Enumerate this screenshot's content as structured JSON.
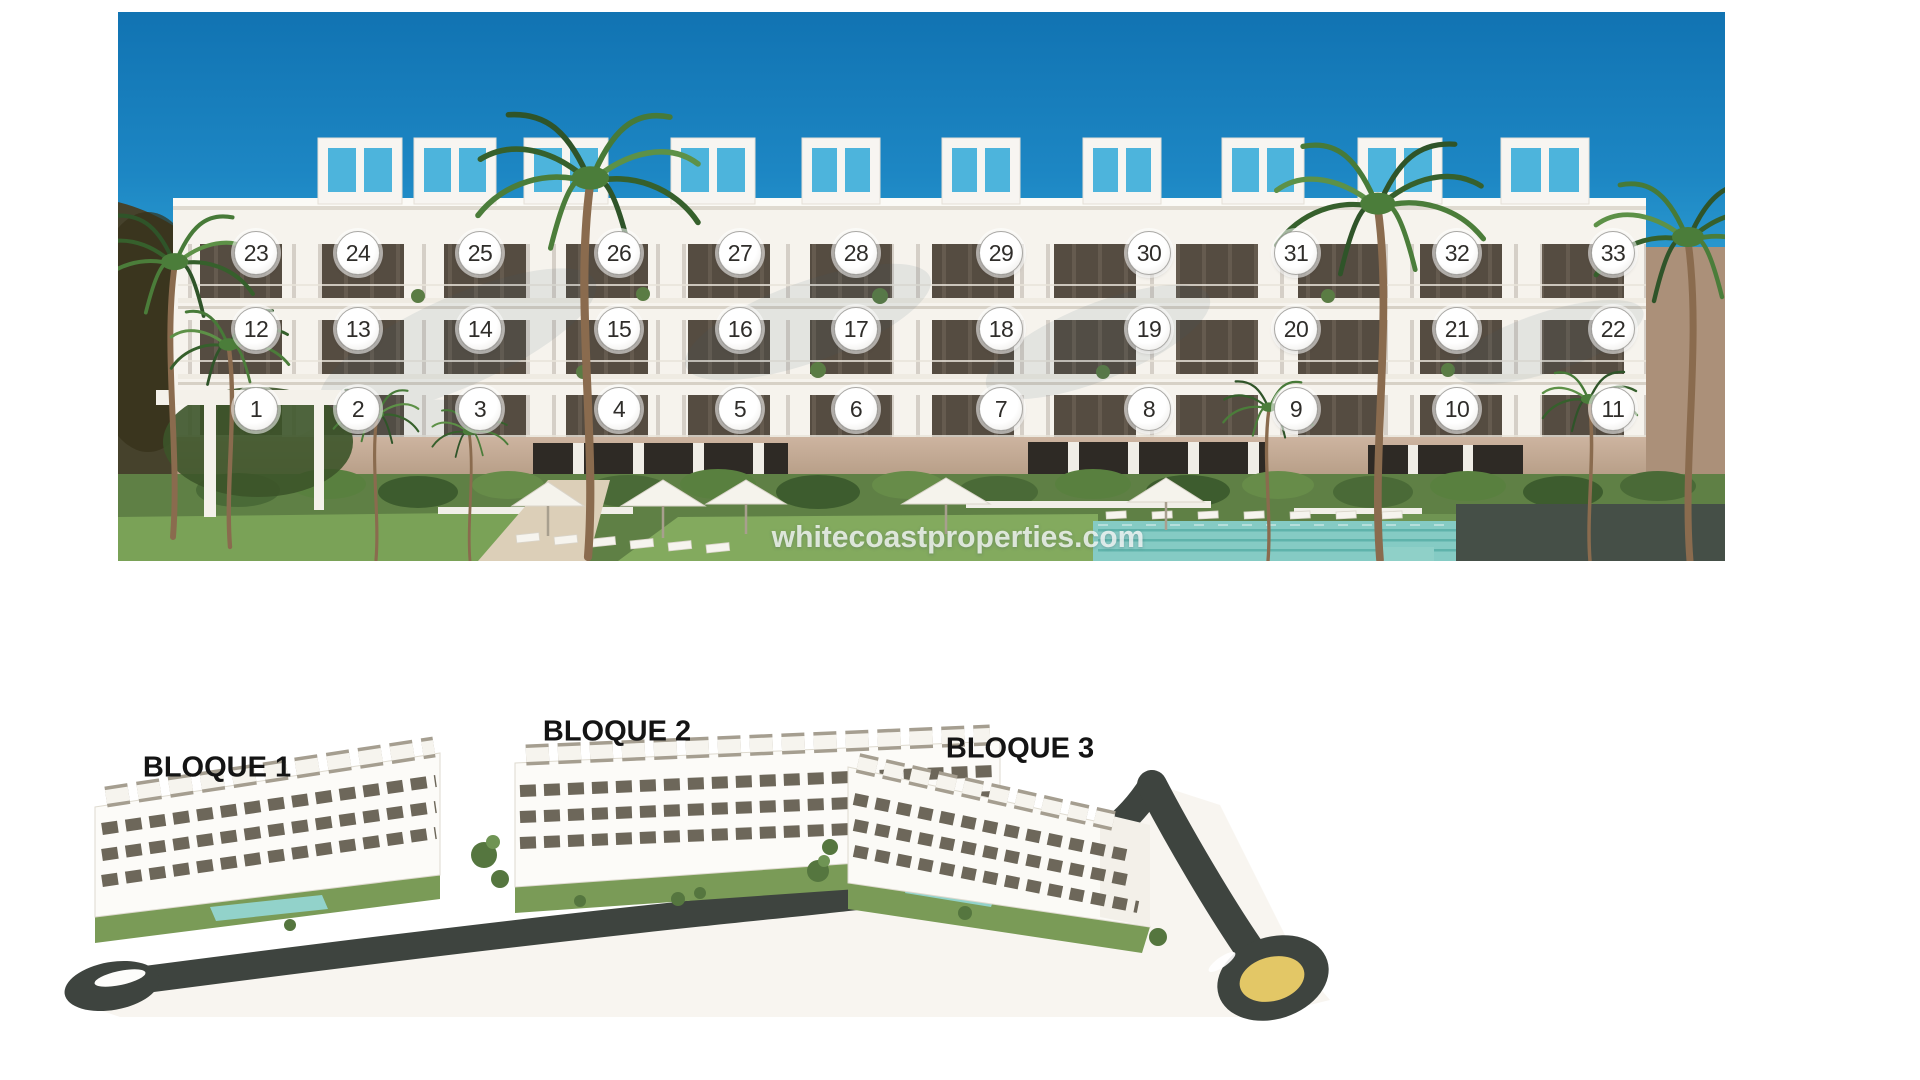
{
  "top_render": {
    "floors": [
      [
        "23",
        "24",
        "25",
        "26",
        "27",
        "28",
        "29",
        "30",
        "31",
        "32",
        "33"
      ],
      [
        "12",
        "13",
        "14",
        "15",
        "16",
        "17",
        "18",
        "19",
        "20",
        "21",
        "22"
      ],
      [
        "1",
        "2",
        "3",
        "4",
        "5",
        "6",
        "7",
        "8",
        "9",
        "10",
        "11"
      ]
    ],
    "watermark": "whitecoastproperties.com"
  },
  "bottom_render": {
    "block_labels": [
      "BLOQUE 1",
      "BLOQUE 2",
      "BLOQUE 3"
    ]
  },
  "colors": {
    "sky_top": "#1173b2",
    "sky_light": "#55bce2",
    "facade": "#f6f3ed",
    "base_wall": "#c8ad9a",
    "pool": "#85cbc4",
    "grass": "#7aa156",
    "road": "#3e443f",
    "roundabout_center": "#e3c766",
    "badge_background": "#ffffff",
    "badge_text": "#2f2d2a",
    "block_label_text": "#141414",
    "watermark_text": "rgba(248,250,249,0.8)"
  }
}
